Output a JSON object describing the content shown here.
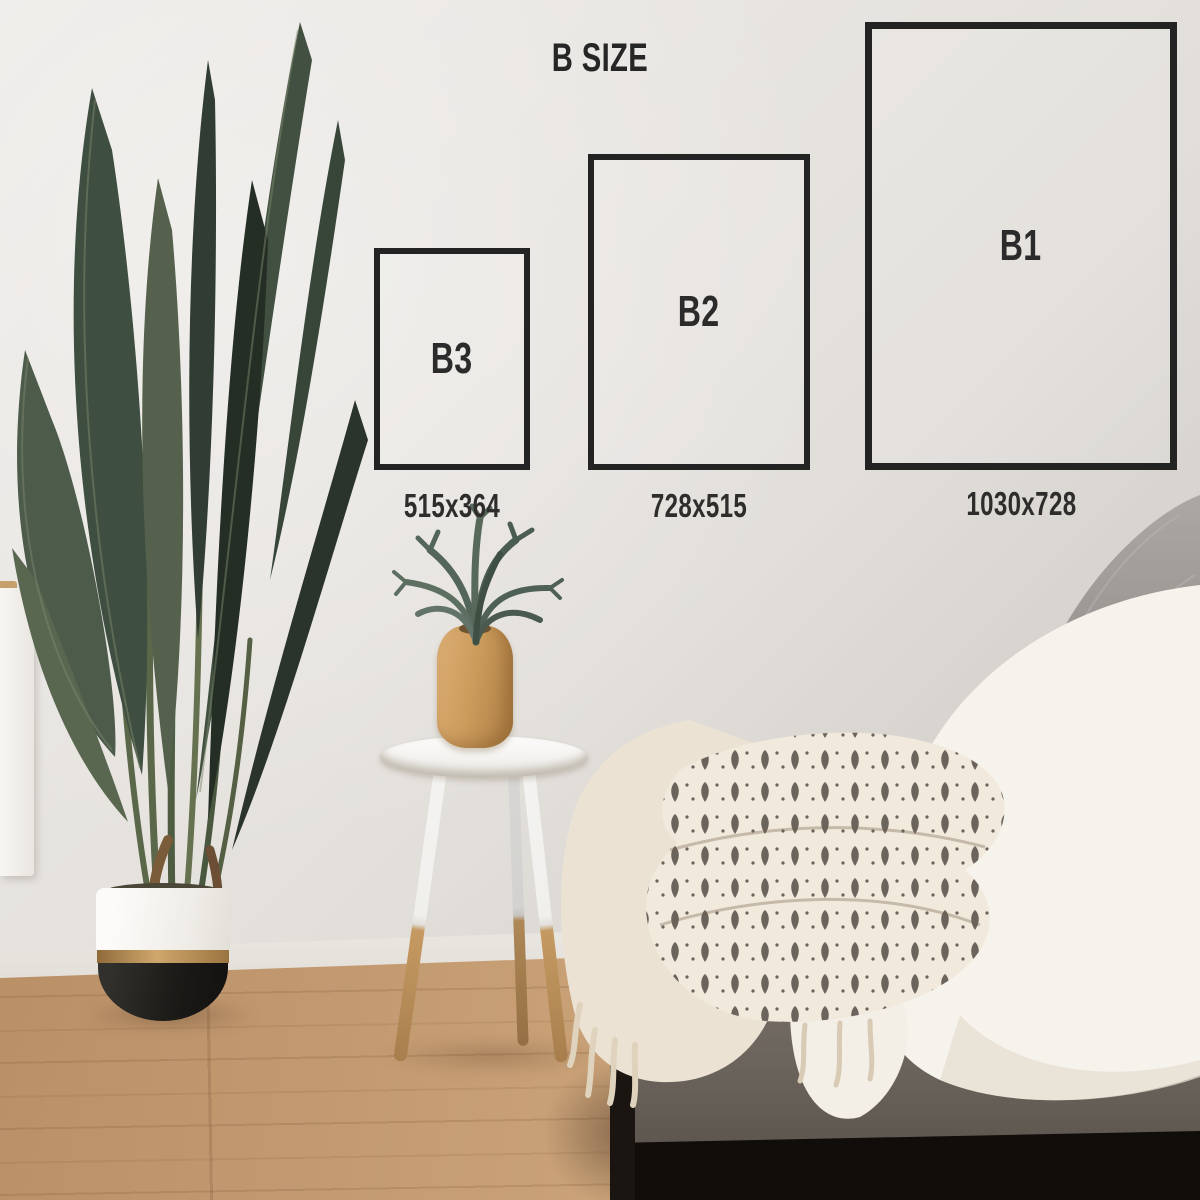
{
  "title": "B SIZE",
  "sizes": [
    {
      "label": "B3",
      "dimensions": "515x364"
    },
    {
      "label": "B2",
      "dimensions": "728x515"
    },
    {
      "label": "B1",
      "dimensions": "1030x728"
    }
  ],
  "colors": {
    "frame_outline": "#232323",
    "text": "#2b2b2b",
    "wall": "#e4e1dd",
    "floor_wood": "#c0996c",
    "pot_gold": "#b68c55",
    "pot_black": "#1c1a17",
    "couch_fabric": "#6f6861",
    "plant_green": "#45543f",
    "blanket_cream": "#ece2d3",
    "sherpa_white": "#f5f1ea"
  }
}
